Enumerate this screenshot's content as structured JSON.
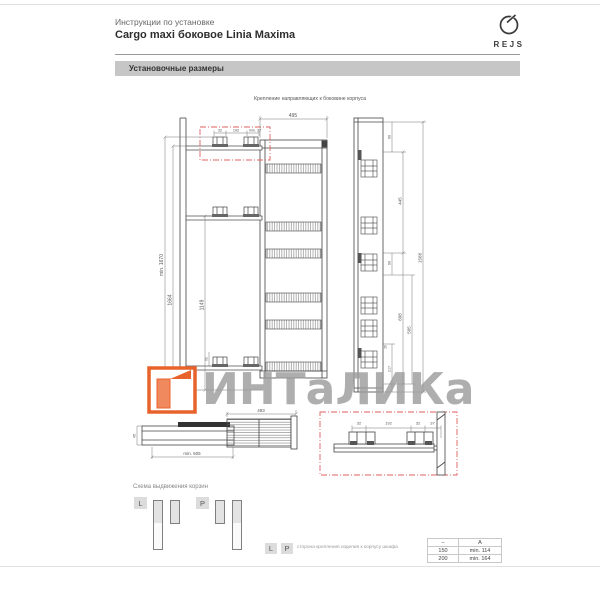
{
  "header": {
    "subtitle": "Инструкции по установке",
    "title": "Cargo maxi боковое Linia Maxima",
    "brand": "REJS"
  },
  "section": {
    "title": "Установочные размеры"
  },
  "drawing": {
    "caption": "Крепление направляющих к боковине корпуса",
    "front": {
      "width": "495",
      "pitch_left": "32",
      "pitch_mid": "192",
      "pitch_right": "min. 37",
      "height_min": "min. 1670",
      "height_rail": "1664",
      "height_mid": "1149",
      "bottom_offset": "92"
    },
    "side": {
      "top_offset": "90",
      "span_upper": "445",
      "mid_offset": "90",
      "span_lower": "608",
      "span_inner": "505",
      "bottom_offset": "217",
      "total_height": "1568",
      "foot": "26"
    },
    "plan": {
      "width": "493",
      "depth_min": "min. 505",
      "rail_height": "45"
    },
    "detail": {
      "d1": "32",
      "d2": "192",
      "d3": "32",
      "d4": "37"
    }
  },
  "schema": {
    "heading": "Схема выдвижения корзин",
    "badge_l": "L",
    "badge_p": "P"
  },
  "legend": {
    "badge_l": "L",
    "badge_p": "P",
    "caption": "сторона крепления изделия к корпусу шкафа"
  },
  "table": {
    "headers": [
      "–",
      "A"
    ],
    "rows": [
      [
        "150",
        "min. 114"
      ],
      [
        "200",
        "min. 164"
      ]
    ]
  },
  "watermark": {
    "text": "ИНТаЛИКа"
  },
  "colors": {
    "accent_red": "#e06060",
    "orange": "#e8632c",
    "bar_gray": "#c6c6c6"
  }
}
